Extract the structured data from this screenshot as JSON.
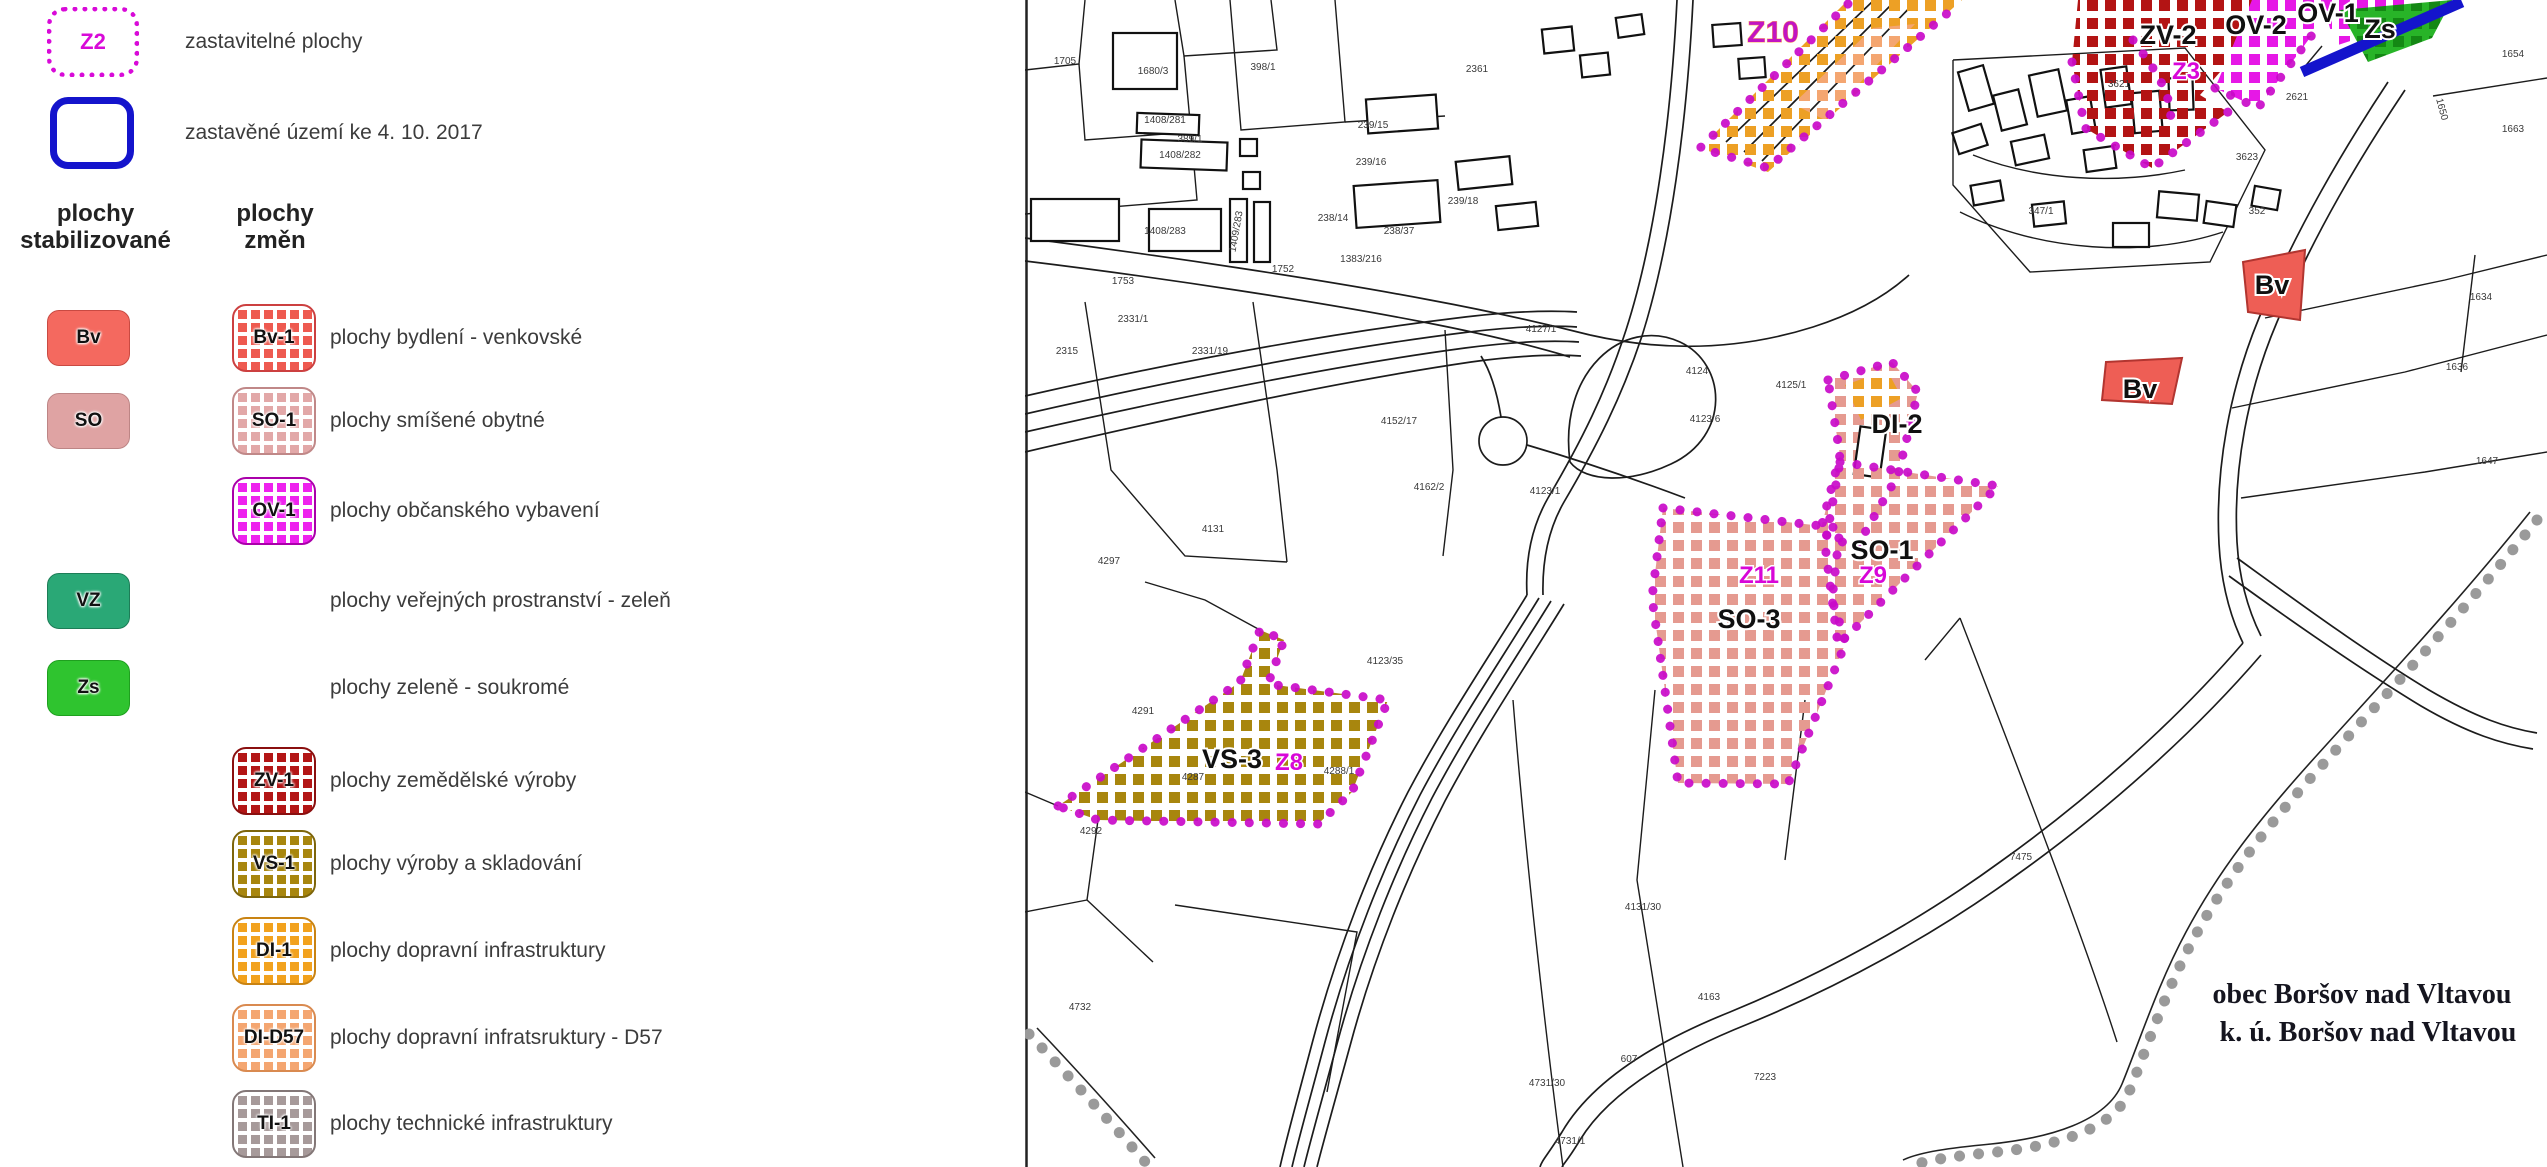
{
  "legend": {
    "zastavitelne": {
      "code": "Z2",
      "label": "zastavitelné plochy"
    },
    "zastavene": {
      "label": "zastavěné území ke 4. 10. 2017"
    },
    "headers": {
      "stable": "plochy stabilizované",
      "changes": "plochy změn"
    },
    "rows": [
      {
        "y": 337,
        "stable": {
          "code": "Bv",
          "bg": "#f4695f",
          "border": "#c94a42"
        },
        "change": {
          "code": "Bv-1",
          "color": "#ee5a50",
          "border": "#cc4040"
        },
        "label": "plochy bydlení - venkovské"
      },
      {
        "y": 420,
        "stable": {
          "code": "SO",
          "bg": "#dfa3a3",
          "border": "#bd8585"
        },
        "change": {
          "code": "SO-1",
          "color": "#e2a8a8",
          "border": "#c08888"
        },
        "label": "plochy smíšené obytné"
      },
      {
        "y": 510,
        "stable": null,
        "change": {
          "code": "OV-1",
          "color": "#ee22ee",
          "border": "#aa00aa"
        },
        "label": "plochy občanského vybavení"
      },
      {
        "y": 600,
        "stable": {
          "code": "VZ",
          "bg": "#2aa876",
          "border": "#1d7d57"
        },
        "change": null,
        "label": "plochy veřejných prostranství - zeleň"
      },
      {
        "y": 687,
        "stable": {
          "code": "Zs",
          "bg": "#2fc42f",
          "border": "#1fa01f"
        },
        "change": null,
        "label": "plochy zeleně - soukromé"
      },
      {
        "y": 780,
        "stable": null,
        "change": {
          "code": "ZV-1",
          "color": "#b31616",
          "border": "#8a0f0f"
        },
        "label": "plochy zemědělské výroby"
      },
      {
        "y": 863,
        "stable": null,
        "change": {
          "code": "VS-1",
          "color": "#a8860e",
          "border": "#7d650b"
        },
        "label": "plochy výroby a skladování"
      },
      {
        "y": 950,
        "stable": null,
        "change": {
          "code": "DI-1",
          "color": "#f2a21e",
          "border": "#c98312"
        },
        "label": "plochy dopravní infrastruktury"
      },
      {
        "y": 1037,
        "stable": null,
        "change": {
          "code": "DI-D57",
          "color": "#f4a671",
          "border": "#d98a50"
        },
        "label": "plochy dopravní infratsruktury - D57"
      },
      {
        "y": 1123,
        "stable": null,
        "change": {
          "code": "TI-1",
          "color": "#a79a9a",
          "border": "#837777"
        },
        "label": "plochy technické infrastruktury"
      }
    ]
  },
  "map": {
    "zone_labels": [
      {
        "text": "Z10",
        "x": 748,
        "y": 42,
        "style": "mag-big"
      },
      {
        "text": "ZV-2",
        "x": 1143,
        "y": 44,
        "style": "blk"
      },
      {
        "text": "Z3",
        "x": 1161,
        "y": 79,
        "style": "mag"
      },
      {
        "text": "OV-2",
        "x": 1231,
        "y": 34,
        "style": "blk"
      },
      {
        "text": "OV-1",
        "x": 1303,
        "y": 22,
        "style": "blk"
      },
      {
        "text": "Zs",
        "x": 1355,
        "y": 38,
        "style": "blk"
      },
      {
        "text": "Bv",
        "x": 1247,
        "y": 294,
        "style": "blk"
      },
      {
        "text": "Bv",
        "x": 1115,
        "y": 398,
        "style": "blk"
      },
      {
        "text": "DI-2",
        "x": 872,
        "y": 433,
        "style": "blk"
      },
      {
        "text": "SO-1",
        "x": 857,
        "y": 559,
        "style": "blk"
      },
      {
        "text": "Z9",
        "x": 848,
        "y": 583,
        "style": "mag"
      },
      {
        "text": "Z11",
        "x": 734,
        "y": 583,
        "style": "mag"
      },
      {
        "text": "SO-3",
        "x": 724,
        "y": 628,
        "style": "blk"
      },
      {
        "text": "VS-3",
        "x": 207,
        "y": 768,
        "style": "blk"
      },
      {
        "text": "Z8",
        "x": 264,
        "y": 770,
        "style": "mag"
      }
    ],
    "municipality_labels": [
      {
        "text": "obec Boršov nad Vltavou",
        "x": 1337,
        "y": 1003
      },
      {
        "text": "k. ú. Boršov nad Vltavou",
        "x": 1343,
        "y": 1041
      }
    ],
    "parcel_numbers": [
      {
        "t": "1705",
        "x": 40,
        "y": 64
      },
      {
        "t": "1680/3",
        "x": 128,
        "y": 74
      },
      {
        "t": "398/1",
        "x": 238,
        "y": 70
      },
      {
        "t": "1408/281",
        "x": 140,
        "y": 123
      },
      {
        "t": "389/1",
        "x": 165,
        "y": 142
      },
      {
        "t": "1408/282",
        "x": 155,
        "y": 158
      },
      {
        "t": "1408/283",
        "x": 140,
        "y": 234
      },
      {
        "t": "1409/283",
        "x": 214,
        "y": 232,
        "r": -80
      },
      {
        "t": "1753",
        "x": 98,
        "y": 284
      },
      {
        "t": "1752",
        "x": 258,
        "y": 272
      },
      {
        "t": "2315",
        "x": 42,
        "y": 354
      },
      {
        "t": "2331/19",
        "x": 185,
        "y": 354
      },
      {
        "t": "2331/1",
        "x": 108,
        "y": 322
      },
      {
        "t": "239/15",
        "x": 348,
        "y": 128
      },
      {
        "t": "239/16",
        "x": 346,
        "y": 165
      },
      {
        "t": "239/18",
        "x": 438,
        "y": 204
      },
      {
        "t": "238/14",
        "x": 308,
        "y": 221
      },
      {
        "t": "238/37",
        "x": 374,
        "y": 234
      },
      {
        "t": "1383/216",
        "x": 336,
        "y": 262
      },
      {
        "t": "2361",
        "x": 452,
        "y": 72
      },
      {
        "t": "4124",
        "x": 672,
        "y": 374
      },
      {
        "t": "4125/1",
        "x": 766,
        "y": 388
      },
      {
        "t": "4123/6",
        "x": 680,
        "y": 422
      },
      {
        "t": "4123/1",
        "x": 520,
        "y": 494
      },
      {
        "t": "4127/1",
        "x": 516,
        "y": 332
      },
      {
        "t": "4131",
        "x": 188,
        "y": 532
      },
      {
        "t": "4152/17",
        "x": 374,
        "y": 424
      },
      {
        "t": "4162/2",
        "x": 404,
        "y": 490
      },
      {
        "t": "4123/35",
        "x": 360,
        "y": 664
      },
      {
        "t": "4297",
        "x": 84,
        "y": 564
      },
      {
        "t": "4291",
        "x": 118,
        "y": 714
      },
      {
        "t": "4287",
        "x": 168,
        "y": 780
      },
      {
        "t": "4288/1",
        "x": 314,
        "y": 774
      },
      {
        "t": "4292",
        "x": 66,
        "y": 834
      },
      {
        "t": "4131/30",
        "x": 618,
        "y": 910
      },
      {
        "t": "4163",
        "x": 684,
        "y": 1000
      },
      {
        "t": "607",
        "x": 604,
        "y": 1062
      },
      {
        "t": "7223",
        "x": 740,
        "y": 1080
      },
      {
        "t": "7475",
        "x": 996,
        "y": 860
      },
      {
        "t": "1634",
        "x": 1456,
        "y": 300
      },
      {
        "t": "1636",
        "x": 1432,
        "y": 370
      },
      {
        "t": "1647",
        "x": 1462,
        "y": 464
      },
      {
        "t": "1650",
        "x": 1414,
        "y": 110,
        "r": 75
      },
      {
        "t": "1663",
        "x": 1488,
        "y": 132
      },
      {
        "t": "1654",
        "x": 1488,
        "y": 57
      },
      {
        "t": "2621",
        "x": 1272,
        "y": 100
      },
      {
        "t": "3621",
        "x": 1094,
        "y": 87
      },
      {
        "t": "3623",
        "x": 1222,
        "y": 160
      },
      {
        "t": "347/1",
        "x": 1016,
        "y": 214
      },
      {
        "t": "352",
        "x": 1232,
        "y": 214
      },
      {
        "t": "4731/1",
        "x": 545,
        "y": 1144
      },
      {
        "t": "4731/30",
        "x": 522,
        "y": 1086
      },
      {
        "t": "4732",
        "x": 55,
        "y": 1010
      }
    ]
  },
  "colors": {
    "zone_dot_border": "#c90ac9",
    "built_boundary_blue": "#1414cc",
    "municipal_boundary_gray": "#9a9a9a",
    "label_magenta": "#d806d8",
    "label_black": "#101010",
    "so_checker": "#e59a90",
    "vs_checker": "#a8860e",
    "di_checker": "#eda025",
    "di_d57_checker": "#f4a671",
    "zv_checker": "#b31414",
    "ov_checker": "#e618e6",
    "zs_fill": "#2db82d",
    "bv_fill": "#ee5e55"
  }
}
